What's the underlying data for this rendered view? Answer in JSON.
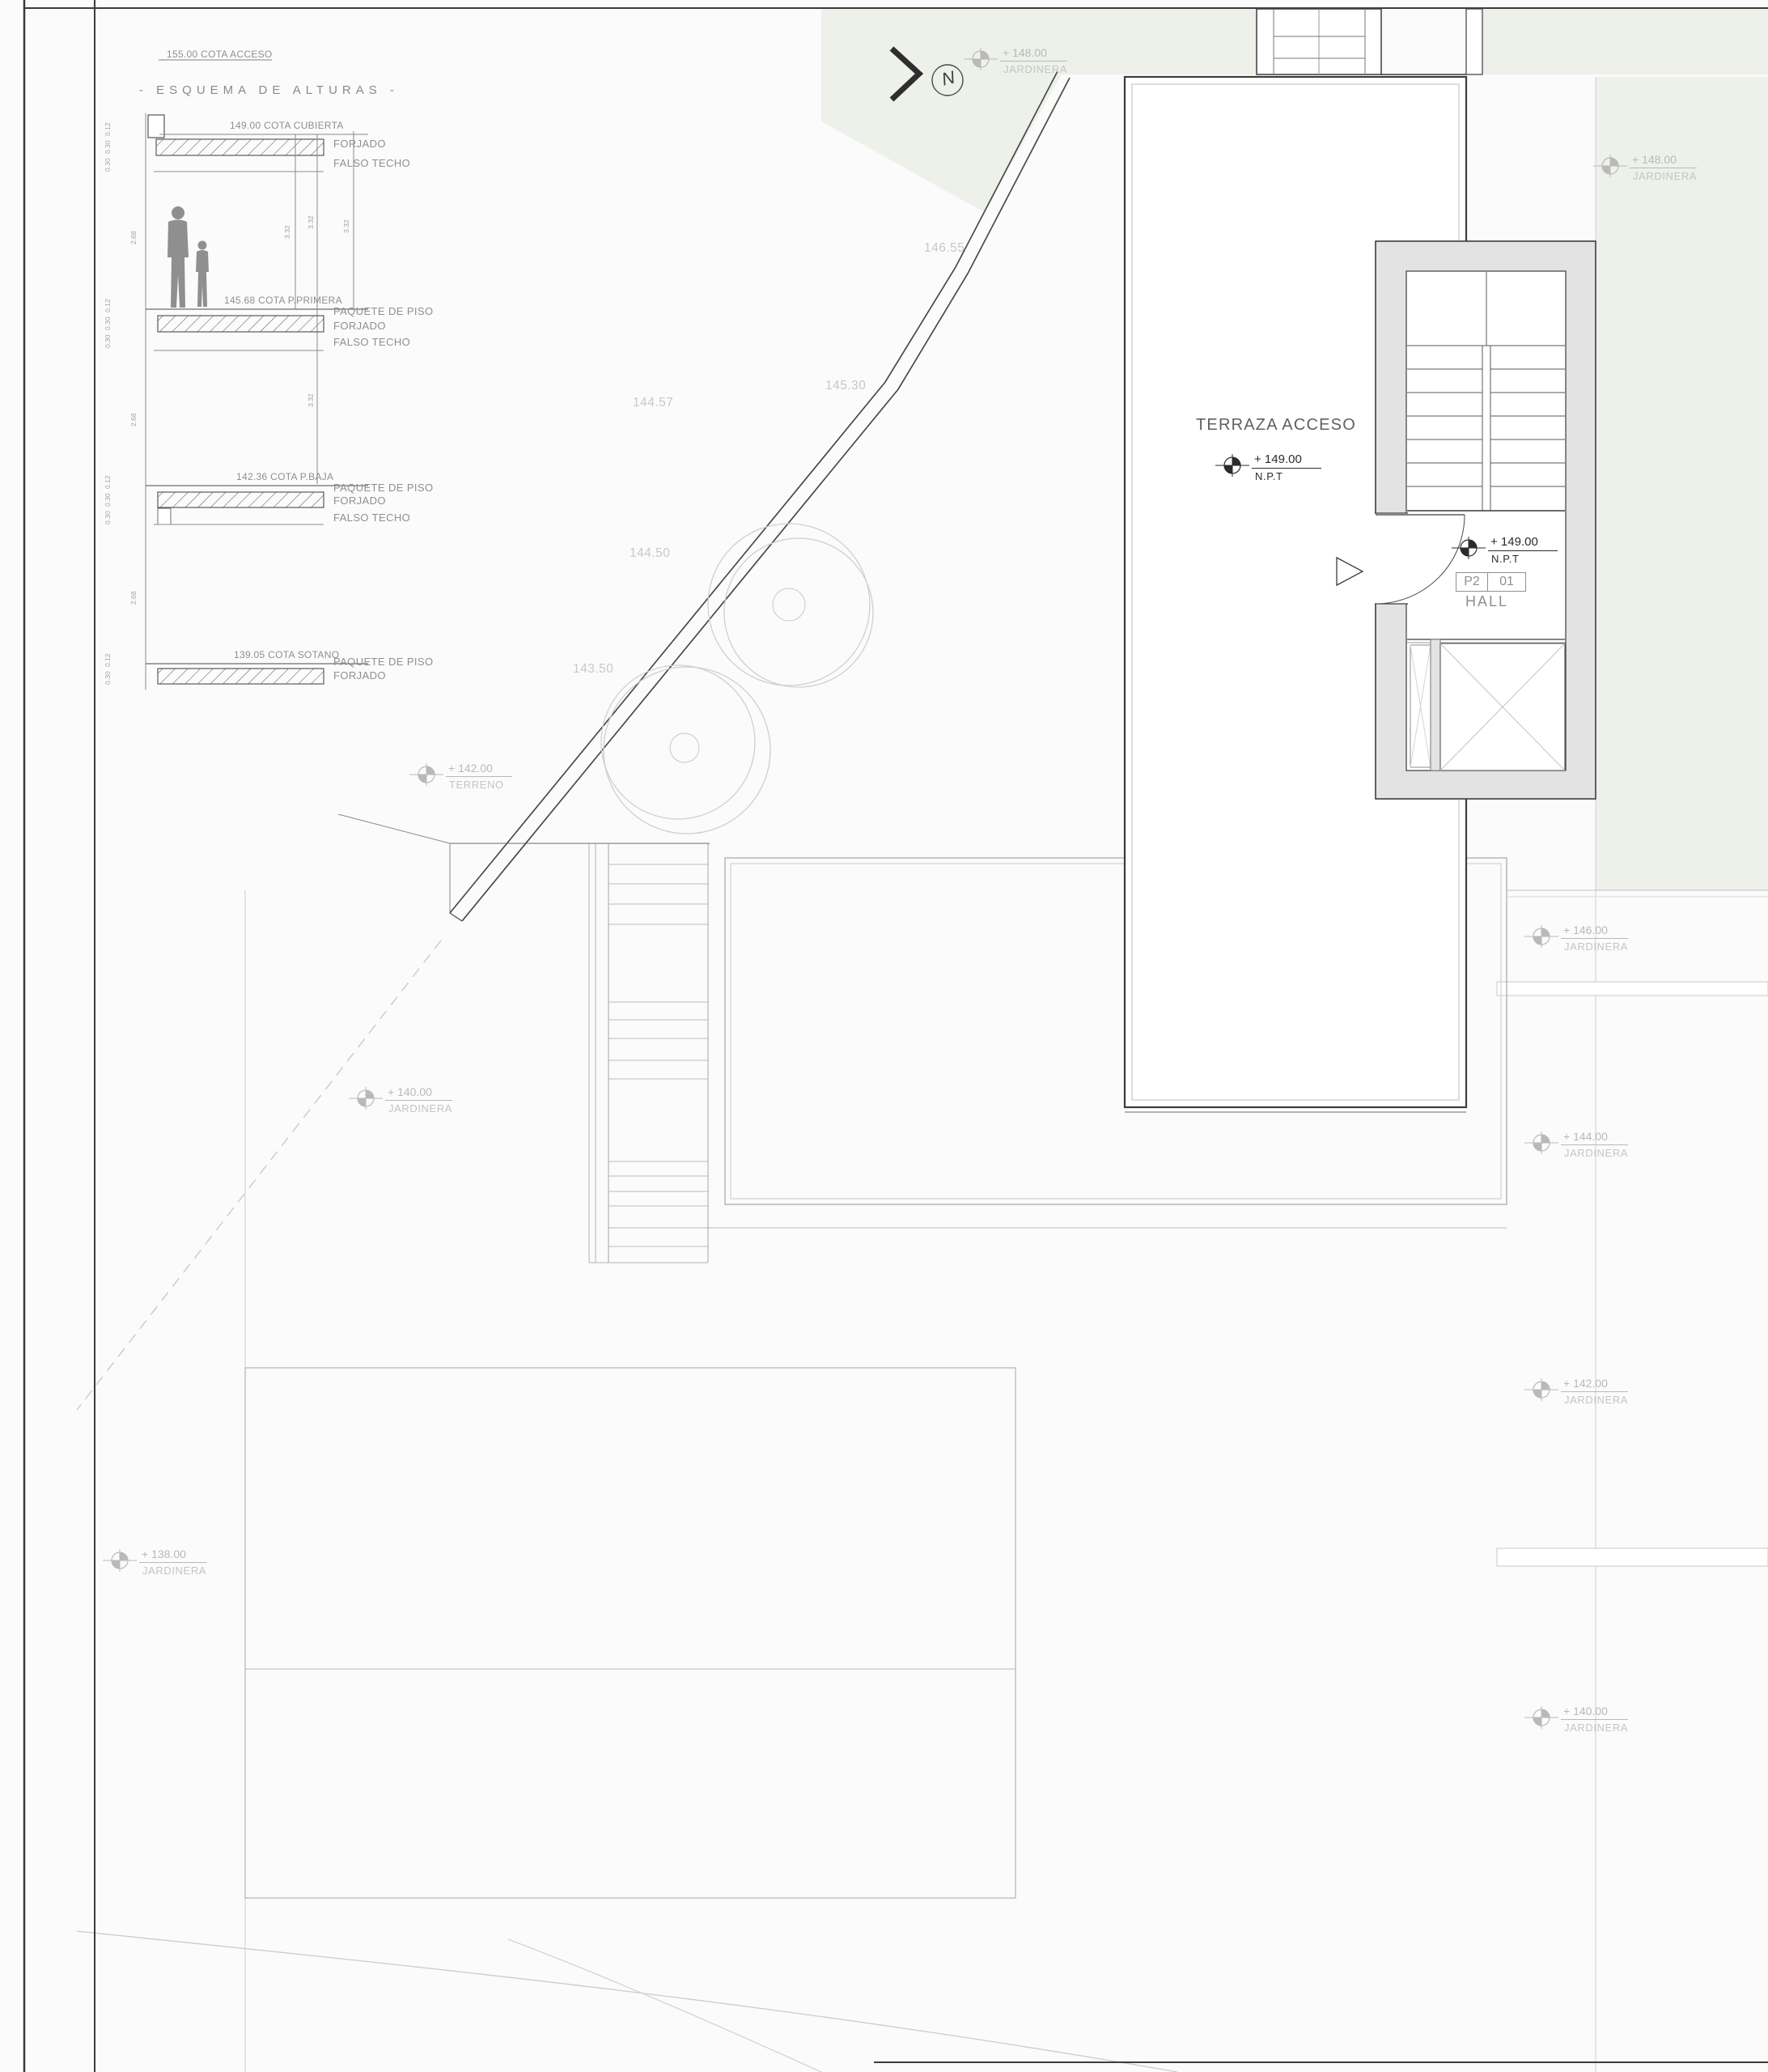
{
  "esquema": {
    "cota_acceso": "155.00 COTA ACCESO",
    "title": "- ESQUEMA DE ALTURAS -",
    "levels": [
      {
        "cota": "149.00 COTA CUBIERTA",
        "l1": "FORJADO",
        "l2": "FALSO TECHO"
      },
      {
        "cota": "145.68 COTA P.PRIMERA",
        "l0": "PAQUETE DE PISO",
        "l1": "FORJADO",
        "l2": "FALSO TECHO"
      },
      {
        "cota": "142.36 COTA P.BAJA",
        "l0": "PAQUETE DE PISO",
        "l1": "FORJADO",
        "l2": "FALSO TECHO"
      },
      {
        "cota": "139.05 COTA SOTANO",
        "l0": "PAQUETE DE PISO",
        "l1": "FORJADO"
      }
    ],
    "dims": {
      "story": "2.68",
      "floor": "3.32",
      "t1": "0.12",
      "t2": "0.30",
      "t3": "0.30"
    }
  },
  "plan": {
    "north_letter": "N",
    "terraza_label": "TERRAZA ACCESO",
    "npt": [
      {
        "value": "+ 149.00",
        "sub": "N.P.T"
      },
      {
        "value": "+ 149.00",
        "sub": "N.P.T"
      }
    ],
    "room_tag": {
      "code": "P2",
      "num": "01",
      "name": "HALL"
    },
    "markers": [
      {
        "value": "+ 148.00",
        "sub": "JARDINERA"
      },
      {
        "value": "+ 148.00",
        "sub": "JARDINERA"
      },
      {
        "value": "+ 142.00",
        "sub": "TERRENO"
      },
      {
        "value": "+ 140.00",
        "sub": "JARDINERA"
      },
      {
        "value": "+ 138.00",
        "sub": "JARDINERA"
      },
      {
        "value": "+ 146.00",
        "sub": "JARDINERA"
      },
      {
        "value": "+ 144.00",
        "sub": "JARDINERA"
      },
      {
        "value": "+ 142.00",
        "sub": "JARDINERA"
      },
      {
        "value": "+ 140.00",
        "sub": "JARDINERA"
      }
    ],
    "spots": [
      "146.55",
      "145.30",
      "144.57",
      "144.50",
      "143.50"
    ]
  },
  "colors": {
    "line_dark": "#3d3d3d",
    "line_light": "#c9c9c9",
    "wall_fill": "#e3e3e3",
    "green_tint": "#edf1ea",
    "label_light": "#bcbcbc",
    "label_mid": "#8e8e8e"
  }
}
